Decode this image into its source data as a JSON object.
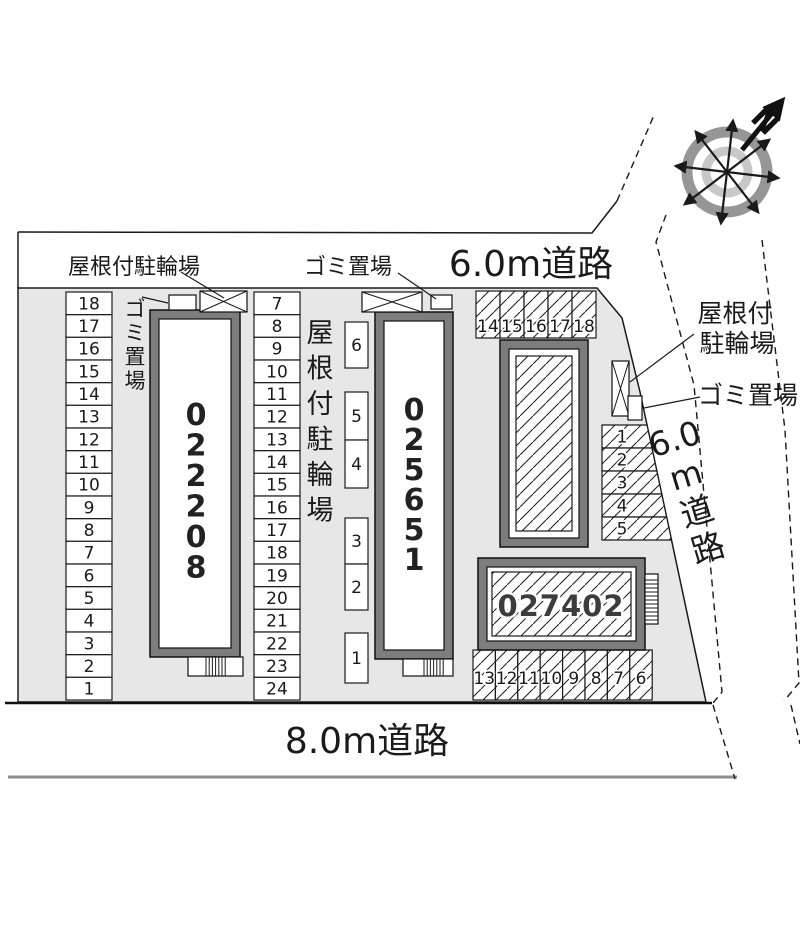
{
  "compass": {
    "north_label": "N"
  },
  "roads": {
    "top": "6.0m道路",
    "bottom": "8.0m道路",
    "right_units": [
      "6.0",
      "m",
      "道",
      "路"
    ]
  },
  "labels": {
    "top_bicycle": "屋根付駐輪場",
    "top_garbage": "ゴミ置場",
    "left_garbage_vertical": "ゴミ置場",
    "mid_bicycle_vertical": "屋根付駐輪場",
    "right_bicycle_line1": "屋根付",
    "right_bicycle_line2": "駐輪場",
    "right_garbage": "ゴミ置場"
  },
  "buildings": [
    {
      "number": "022208"
    },
    {
      "number": "025651"
    },
    {
      "number": "027402"
    }
  ],
  "parking": {
    "left_column": [
      "18",
      "17",
      "16",
      "15",
      "14",
      "13",
      "12",
      "11",
      "10",
      "9",
      "8",
      "7",
      "6",
      "5",
      "4",
      "3",
      "2",
      "1"
    ],
    "middle_column": [
      "7",
      "8",
      "9",
      "10",
      "11",
      "12",
      "13",
      "14",
      "15",
      "16",
      "17",
      "18",
      "19",
      "20",
      "21",
      "22",
      "23",
      "24"
    ],
    "middle_small": [
      "6",
      "5",
      "4",
      "3",
      "2",
      "1"
    ],
    "top_right_row": [
      "14",
      "15",
      "16",
      "17",
      "18"
    ],
    "right_column": [
      "1",
      "2",
      "3",
      "4",
      "5"
    ],
    "bottom_row": [
      "13",
      "12",
      "11",
      "10",
      "9",
      "8",
      "7",
      "6"
    ]
  },
  "colors": {
    "line": "#1a1a1a",
    "site_fill": "#e7e7e7",
    "building_frame": "#7d7d7d",
    "compass_outer": "#969696",
    "compass_inner": "#c8c8c8",
    "road_line_gray": "#8f8f8f"
  }
}
